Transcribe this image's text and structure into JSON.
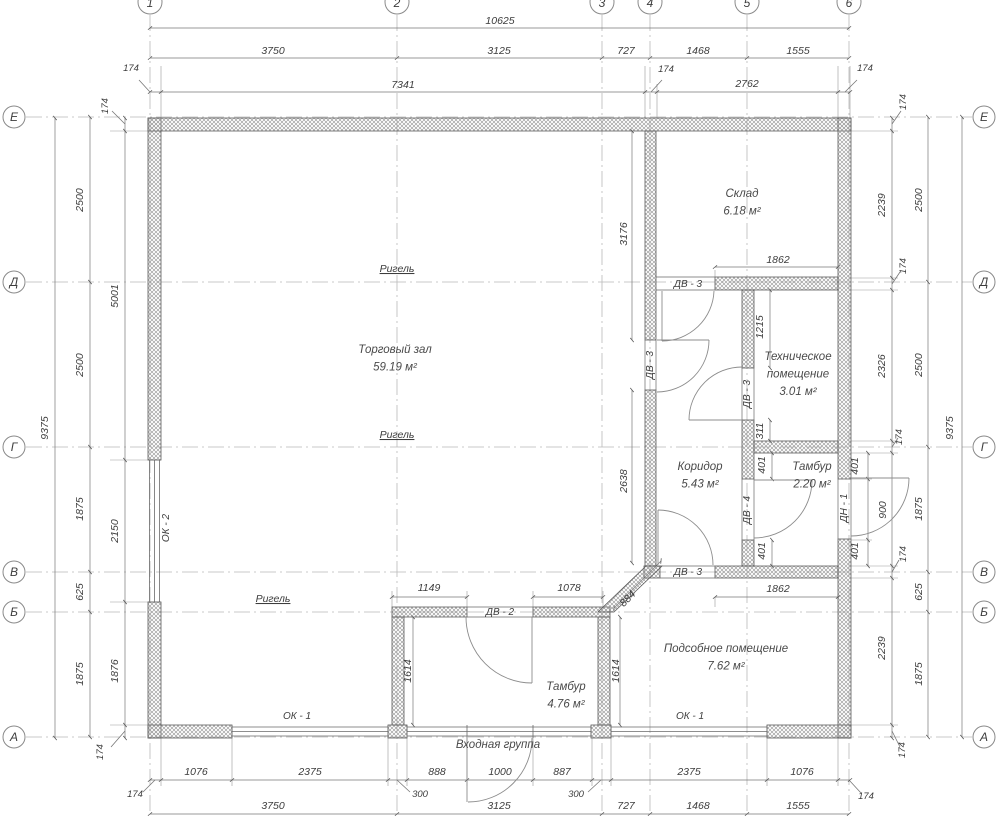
{
  "plan": {
    "type": "architectural floor plan",
    "entrance_label": {
      "t": "Входная группа",
      "x": 498,
      "y": 748
    }
  },
  "axes": {
    "top": [
      {
        "label": "1",
        "x": 150
      },
      {
        "label": "2",
        "x": 397
      },
      {
        "label": "3",
        "x": 602
      },
      {
        "label": "4",
        "x": 650
      },
      {
        "label": "5",
        "x": 747
      },
      {
        "label": "6",
        "x": 849
      }
    ],
    "side": [
      {
        "label": "Е",
        "y": 117
      },
      {
        "label": "Д",
        "y": 282
      },
      {
        "label": "Г",
        "y": 447
      },
      {
        "label": "В",
        "y": 572
      },
      {
        "label": "Б",
        "y": 612
      },
      {
        "label": "А",
        "y": 737
      }
    ]
  },
  "rooms": [
    {
      "name": "Склад",
      "area": "6.18 м²",
      "x": 742,
      "y": 197,
      "lines": [
        "Склад",
        "6.18 м²"
      ]
    },
    {
      "name": "Торговый зал",
      "area": "59.19 м²",
      "x": 395,
      "y": 353,
      "lines": [
        "Торговый зал",
        "59.19 м²"
      ]
    },
    {
      "name": "Техническое помещение",
      "area": "3.01 м²",
      "x": 798,
      "y": 360,
      "lines": [
        "Техническое",
        "помещение",
        "3.01 м²"
      ]
    },
    {
      "name": "Коридор",
      "area": "5.43 м²",
      "x": 700,
      "y": 470,
      "lines": [
        "Коридор",
        "5.43 м²"
      ]
    },
    {
      "name": "Тамбур",
      "area": "2.20 м²",
      "x": 812,
      "y": 470,
      "lines": [
        "Тамбур",
        "2.20 м²"
      ]
    },
    {
      "name": "Подсобное помещение",
      "area": "7.62 м²",
      "x": 726,
      "y": 652,
      "lines": [
        "Подсобное помещение",
        "7.62 м²"
      ]
    },
    {
      "name": "Тамбур",
      "area": "4.76 м²",
      "x": 566,
      "y": 690,
      "lines": [
        "Тамбур",
        "4.76 м²"
      ]
    }
  ],
  "beams": [
    {
      "t": "Ригель",
      "x": 397,
      "y": 272
    },
    {
      "t": "Ригель",
      "x": 397,
      "y": 438
    },
    {
      "t": "Ригель",
      "x": 273,
      "y": 602
    }
  ],
  "openings": [
    {
      "t": "ДВ - 3",
      "x": 688,
      "y": 287,
      "r": 0
    },
    {
      "t": "ДВ - 3",
      "x": 653,
      "y": 365,
      "r": -90
    },
    {
      "t": "ДВ - 3",
      "x": 750,
      "y": 394,
      "r": -90
    },
    {
      "t": "ДВ - 4",
      "x": 750,
      "y": 510,
      "r": -90
    },
    {
      "t": "ДН - 1",
      "x": 847,
      "y": 508,
      "r": -90
    },
    {
      "t": "ДВ - 3",
      "x": 688,
      "y": 575,
      "r": 0
    },
    {
      "t": "ДВ - 2",
      "x": 500,
      "y": 615,
      "r": 0
    },
    {
      "t": "ОК - 1",
      "x": 297,
      "y": 719,
      "r": 0
    },
    {
      "t": "ОК - 1",
      "x": 690,
      "y": 719,
      "r": 0
    },
    {
      "t": "ОК - 2",
      "x": 169,
      "y": 528,
      "r": -90
    }
  ],
  "dims": [
    {
      "t": "10625",
      "x": 500,
      "y": 24,
      "r": 0
    },
    {
      "t": "3750",
      "x": 273,
      "y": 54,
      "r": 0
    },
    {
      "t": "3125",
      "x": 499,
      "y": 54,
      "r": 0
    },
    {
      "t": "727",
      "x": 626,
      "y": 54,
      "r": 0
    },
    {
      "t": "1468",
      "x": 698,
      "y": 54,
      "r": 0
    },
    {
      "t": "1555",
      "x": 798,
      "y": 54,
      "r": 0
    },
    {
      "t": "174",
      "x": 131,
      "y": 71,
      "r": 0,
      "small": true
    },
    {
      "t": "7341",
      "x": 403,
      "y": 88,
      "r": 0
    },
    {
      "t": "174",
      "x": 666,
      "y": 72,
      "r": 0,
      "small": true
    },
    {
      "t": "2762",
      "x": 747,
      "y": 87,
      "r": 0
    },
    {
      "t": "174",
      "x": 865,
      "y": 71,
      "r": 0,
      "small": true
    },
    {
      "t": "1076",
      "x": 196,
      "y": 775,
      "r": 0
    },
    {
      "t": "2375",
      "x": 310,
      "y": 775,
      "r": 0
    },
    {
      "t": "888",
      "x": 437,
      "y": 775,
      "r": 0
    },
    {
      "t": "1000",
      "x": 500,
      "y": 775,
      "r": 0
    },
    {
      "t": "887",
      "x": 562,
      "y": 775,
      "r": 0
    },
    {
      "t": "2375",
      "x": 689,
      "y": 775,
      "r": 0
    },
    {
      "t": "1076",
      "x": 802,
      "y": 775,
      "r": 0
    },
    {
      "t": "174",
      "x": 135,
      "y": 797,
      "r": 0,
      "small": true
    },
    {
      "t": "300",
      "x": 420,
      "y": 797,
      "r": 0,
      "small": true
    },
    {
      "t": "300",
      "x": 576,
      "y": 797,
      "r": 0,
      "small": true
    },
    {
      "t": "174",
      "x": 866,
      "y": 799,
      "r": 0,
      "small": true
    },
    {
      "t": "3750",
      "x": 273,
      "y": 809,
      "r": 0
    },
    {
      "t": "3125",
      "x": 499,
      "y": 809,
      "r": 0
    },
    {
      "t": "727",
      "x": 626,
      "y": 809,
      "r": 0
    },
    {
      "t": "1468",
      "x": 698,
      "y": 809,
      "r": 0
    },
    {
      "t": "1555",
      "x": 798,
      "y": 809,
      "r": 0
    },
    {
      "t": "9375",
      "x": 48,
      "y": 428,
      "r": -90
    },
    {
      "t": "2500",
      "x": 83,
      "y": 200,
      "r": -90
    },
    {
      "t": "2500",
      "x": 83,
      "y": 365,
      "r": -90
    },
    {
      "t": "1875",
      "x": 83,
      "y": 509,
      "r": -90
    },
    {
      "t": "625",
      "x": 83,
      "y": 592,
      "r": -90
    },
    {
      "t": "1875",
      "x": 83,
      "y": 674,
      "r": -90
    },
    {
      "t": "174",
      "x": 108,
      "y": 106,
      "r": -90,
      "small": true
    },
    {
      "t": "5001",
      "x": 118,
      "y": 296,
      "r": -90
    },
    {
      "t": "2150",
      "x": 118,
      "y": 531,
      "r": -90
    },
    {
      "t": "1876",
      "x": 118,
      "y": 671,
      "r": -90
    },
    {
      "t": "174",
      "x": 103,
      "y": 752,
      "r": -90,
      "small": true
    },
    {
      "t": "174",
      "x": 906,
      "y": 102,
      "r": -90,
      "small": true
    },
    {
      "t": "2239",
      "x": 885,
      "y": 205,
      "r": -90
    },
    {
      "t": "174",
      "x": 906,
      "y": 266,
      "r": -90,
      "small": true
    },
    {
      "t": "2326",
      "x": 885,
      "y": 366,
      "r": -90
    },
    {
      "t": "174",
      "x": 902,
      "y": 437,
      "r": -90,
      "small": true
    },
    {
      "t": "401",
      "x": 858,
      "y": 466,
      "r": -90
    },
    {
      "t": "900",
      "x": 886,
      "y": 510,
      "r": -90
    },
    {
      "t": "401",
      "x": 858,
      "y": 551,
      "r": -90
    },
    {
      "t": "174",
      "x": 906,
      "y": 554,
      "r": -90,
      "small": true
    },
    {
      "t": "2239",
      "x": 885,
      "y": 648,
      "r": -90
    },
    {
      "t": "174",
      "x": 905,
      "y": 750,
      "r": -90,
      "small": true
    },
    {
      "t": "2500",
      "x": 922,
      "y": 200,
      "r": -90
    },
    {
      "t": "2500",
      "x": 922,
      "y": 365,
      "r": -90
    },
    {
      "t": "1875",
      "x": 922,
      "y": 509,
      "r": -90
    },
    {
      "t": "625",
      "x": 922,
      "y": 592,
      "r": -90
    },
    {
      "t": "1875",
      "x": 922,
      "y": 674,
      "r": -90
    },
    {
      "t": "9375",
      "x": 953,
      "y": 428,
      "r": -90
    },
    {
      "t": "3176",
      "x": 627,
      "y": 234,
      "r": -90
    },
    {
      "t": "2638",
      "x": 627,
      "y": 481,
      "r": -90
    },
    {
      "t": "1862",
      "x": 778,
      "y": 263,
      "r": 0
    },
    {
      "t": "1215",
      "x": 763,
      "y": 327,
      "r": -90
    },
    {
      "t": "311",
      "x": 763,
      "y": 431,
      "r": -90
    },
    {
      "t": "401",
      "x": 765,
      "y": 465,
      "r": -90
    },
    {
      "t": "401",
      "x": 765,
      "y": 551,
      "r": -90
    },
    {
      "t": "1149",
      "x": 429,
      "y": 591,
      "r": 0
    },
    {
      "t": "1078",
      "x": 569,
      "y": 591,
      "r": 0
    },
    {
      "t": "884",
      "x": 630,
      "y": 601,
      "r": -45
    },
    {
      "t": "1614",
      "x": 411,
      "y": 671,
      "r": -90
    },
    {
      "t": "1614",
      "x": 619,
      "y": 671,
      "r": -90
    },
    {
      "t": "1862",
      "x": 778,
      "y": 592,
      "r": 0
    }
  ]
}
